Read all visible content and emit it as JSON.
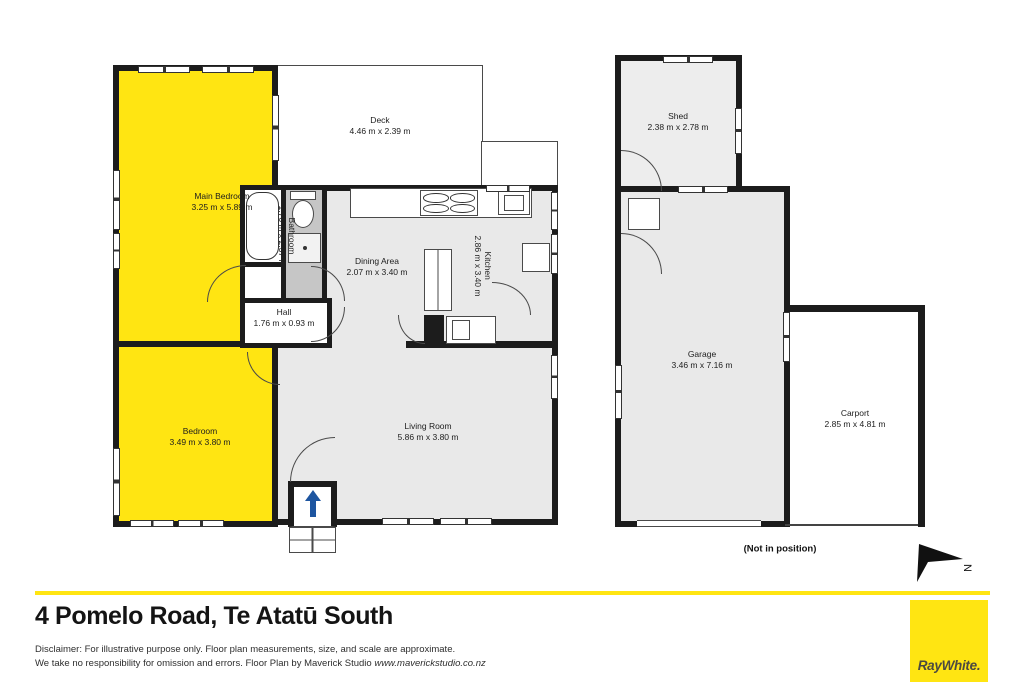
{
  "floorplan": {
    "rooms": {
      "main_bedroom": {
        "label": "Main Bedroom",
        "dims": "3.25 m x 5.89 m"
      },
      "deck": {
        "label": "Deck",
        "dims": "4.46 m x 2.39 m"
      },
      "bathroom": {
        "label": "Bathroom",
        "dims": "1.76 m x 2.37 m"
      },
      "dining_area": {
        "label": "Dining Area",
        "dims": "2.07 m x 3.40 m"
      },
      "kitchen": {
        "label": "Kitchen",
        "dims": "2.86 m x 3.40 m"
      },
      "hall": {
        "label": "Hall",
        "dims": "1.76 m x 0.93 m"
      },
      "bedroom": {
        "label": "Bedroom",
        "dims": "3.49 m x 3.80 m"
      },
      "living_room": {
        "label": "Living Room",
        "dims": "5.86 m x 3.80 m"
      },
      "shed": {
        "label": "Shed",
        "dims": "2.38 m x 2.78 m"
      },
      "garage": {
        "label": "Garage",
        "dims": "3.46 m x 7.16 m"
      },
      "carport": {
        "label": "Carport",
        "dims": "2.85 m x 4.81 m"
      }
    },
    "annotations": {
      "not_in_position": "(Not in position)",
      "north": "N"
    }
  },
  "footer": {
    "address": "4 Pomelo Road, Te Atatū South",
    "disclaimer_line1": "Disclaimer: For illustrative purpose only. Floor plan measurements, size, and scale are approximate.",
    "disclaimer_line2": "We take no responsibility for omission and errors. Floor Plan by Maverick Studio ",
    "disclaimer_url": "www.maverickstudio.co.nz",
    "brand": "RayWhite."
  },
  "colors": {
    "highlight_yellow": "#FFE512",
    "brand_yellow": "#FFE512",
    "floor_gray": "#E9E9E9",
    "bath_gray": "#C6C6C6",
    "wall_black": "#1C1C1C",
    "entrance_arrow_blue": "#1D55A0",
    "brand_text_gray": "#4C4A41"
  }
}
